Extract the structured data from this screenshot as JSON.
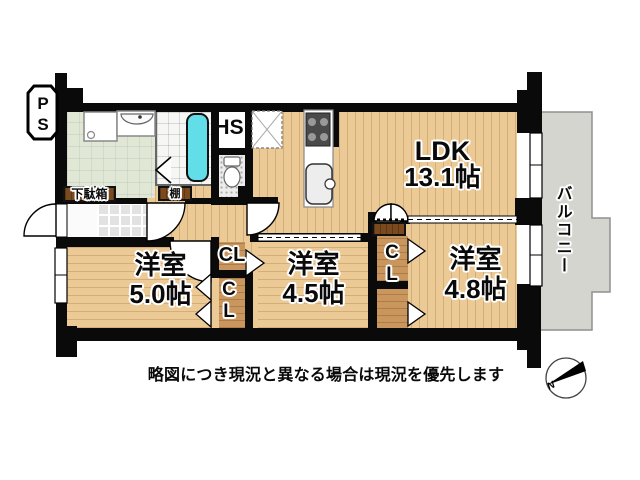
{
  "floor_plan": {
    "disclaimer": "略図につき現況と異なる場合は現況を優先します",
    "compass": {
      "north": "N"
    },
    "labels": {
      "ps": "PS",
      "hs": "HS",
      "shoe_cabinet": "下駄箱",
      "shelf": "棚",
      "closet_a": "CL",
      "closet_b": "CL",
      "closet_c": "CL",
      "balcony": "バルコニー"
    },
    "rooms": [
      {
        "id": "ldk",
        "name": "LDK",
        "size": "13.1帖"
      },
      {
        "id": "bedroom-5.0",
        "name": "洋室",
        "size": "5.0帖"
      },
      {
        "id": "bedroom-4.5",
        "name": "洋室",
        "size": "4.5帖"
      },
      {
        "id": "bedroom-4.8",
        "name": "洋室",
        "size": "4.8帖"
      }
    ],
    "colors": {
      "wall": "#0a0a0a",
      "wood_floor": "#ecca96",
      "closet_floor": "#c9965e",
      "bathtub": "#62dee9",
      "washroom_floor": "#e0e7d4",
      "balcony": "#d5d5d0"
    }
  }
}
